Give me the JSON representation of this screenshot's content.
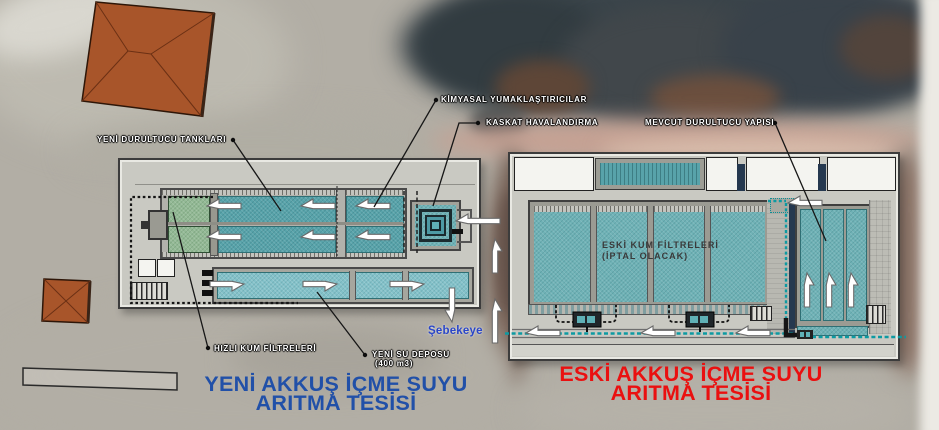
{
  "labels": {
    "yeni_durultucu_tanklari": "YENİ DURULTUCU TANKLARI",
    "kimyasal_yumaklastiricilar": "KİMYASAL YUMAKLAŞTIRICILAR",
    "kaskat_havalandirma": "KASKAT HAVALANDIRMA",
    "mevcut_durultucu_yapisi": "MEVCUT DURULTUCU YAPISI",
    "hizli_kum_filtreleri": "HIZLI KUM FİLTRELERİ",
    "yeni_su_deposu_line1": "YENİ SU DEPOSU",
    "yeni_su_deposu_line2": "(400 m3)",
    "sebekeye": "Şebekeye",
    "eski_kum_filtreleri_line1": "ESKİ KUM FİLTRELERİ",
    "eski_kum_filtreleri_line2": "(İPTAL OLACAK)"
  },
  "titles": {
    "new_plant_line1": "YENİ AKKUŞ İÇME SUYU",
    "new_plant_line2": "ARITMA TESİSİ",
    "old_plant_line1": "ESKİ AKKUŞ İÇME SUYU",
    "old_plant_line2": "ARITMA TESİSİ"
  },
  "colors": {
    "title_blue": "#2150a8",
    "title_red": "#ea1010",
    "network_blue": "#2a46c8",
    "pool_teal": "#6fb2b6",
    "floc_teal": "#58a3aa",
    "filter_green": "#93b995",
    "storage_teal": "#83c1c9",
    "pipe_teal": "#0d9aa2",
    "building_gray": "#c9c9c2",
    "roof_orange": "#a8552a",
    "label_white": "#ffffff",
    "pool_label_gray": "#3a3a3a"
  }
}
